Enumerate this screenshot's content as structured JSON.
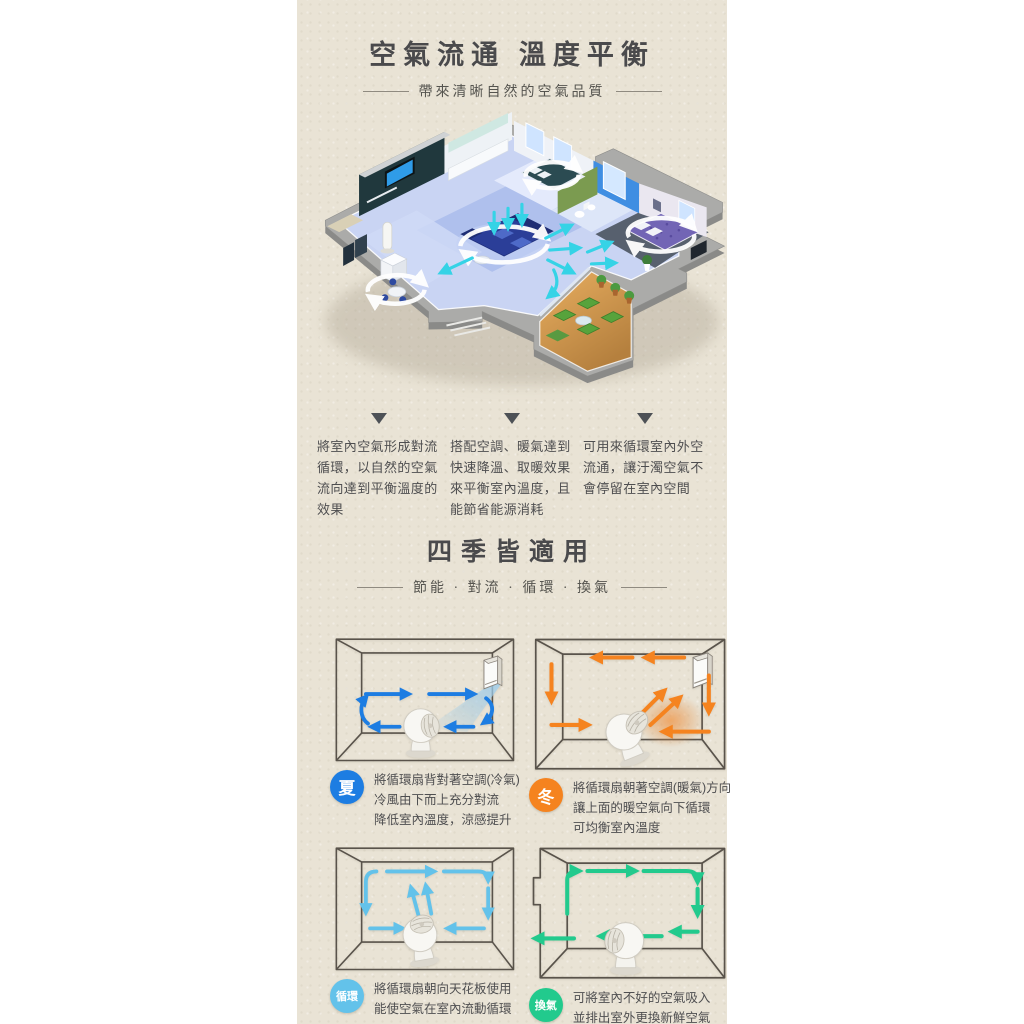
{
  "colors": {
    "panel_bg": "#e9e3d5",
    "heading_text": "#4a4a4c",
    "body_text": "#4e4e50",
    "divider_line": "#8f8a80",
    "marker_triangle": "#4d5156",
    "diagram_outline": "#59534b",
    "summer": "#1d7de2",
    "winter": "#f5831f",
    "circulate": "#63c2ea",
    "ventilate": "#22ca8d",
    "cyan_arrow": "#35d3e6"
  },
  "section_airflow": {
    "title": "空氣流通 溫度平衡",
    "subtitle": "帶來清晰自然的空氣品質",
    "illustration": "isometric-apartment-airflow-cutaway",
    "points": [
      {
        "text": "將室內空氣形成對流循環，以自然的空氣流向達到平衡溫度的效果"
      },
      {
        "text": "搭配空調、暖氣達到快速降溫、取暖效果來平衡室內溫度，且能節省能源消耗"
      },
      {
        "text": "可用來循環室內外空流通，讓汙濁空氣不會停留在室內空間"
      }
    ]
  },
  "section_seasons": {
    "title": "四季皆適用",
    "subtitle": "節能 · 對流 · 循環 · 換氣",
    "modes": [
      {
        "id": "summer",
        "badge": "夏",
        "lines": [
          "將循環扇背對著空調(冷氣)",
          "冷風由下而上充分對流",
          "降低室內溫度，涼感提升"
        ]
      },
      {
        "id": "winter",
        "badge": "冬",
        "lines": [
          "將循環扇朝著空調(暖氣)方向",
          "讓上面的暖空氣向下循環",
          "可均衡室內溫度"
        ]
      },
      {
        "id": "circulate",
        "badge": "循環",
        "lines": [
          "將循環扇朝向天花板使用",
          "能使空氣在室內流動循環"
        ]
      },
      {
        "id": "ventilate",
        "badge": "換氣",
        "lines": [
          "可將室內不好的空氣吸入",
          "並排出室外更換新鮮空氣"
        ]
      }
    ]
  },
  "icons": {
    "marker": "down-triangle",
    "fan": "circulator-fan",
    "ac": "air-conditioner-unit"
  }
}
